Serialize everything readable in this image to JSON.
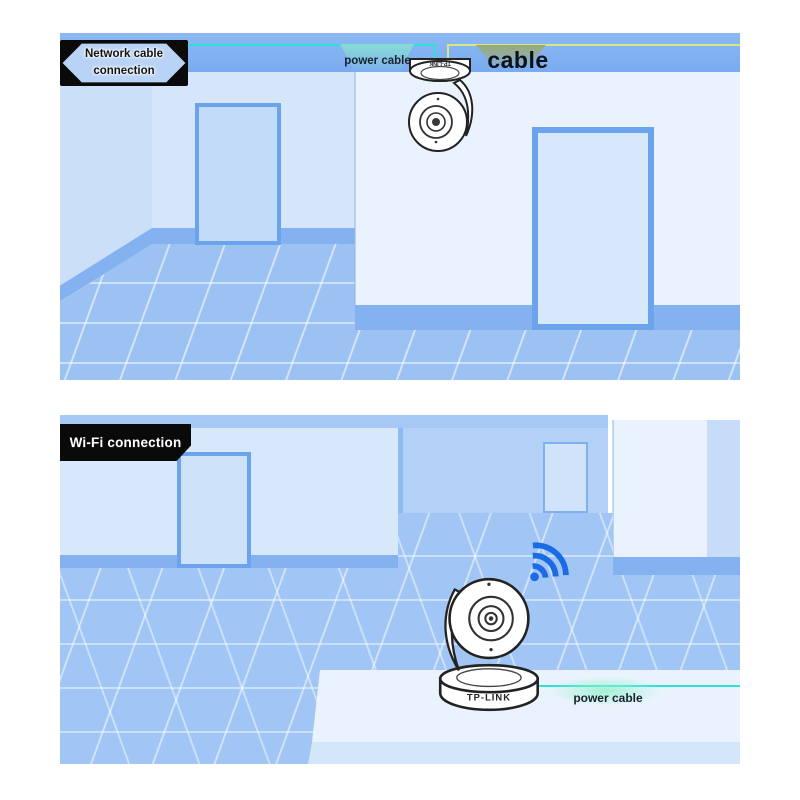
{
  "scene": {
    "top_panel": {
      "label": "Network cable connection",
      "power_cable_label": "power cable",
      "network_cable_label": "cable",
      "camera_brand": "TP-LINK"
    },
    "bottom_panel": {
      "label": "Wi-Fi connection",
      "power_cable_label": "power cable",
      "camera_brand": "TP-LINK"
    },
    "colors": {
      "power_cable": "#2be2d7",
      "power_cable_highlight": "#8fd9d3",
      "network_cable": "#d9e87e",
      "network_cable_highlight": "#9aaa72",
      "wifi_icon": "#1b6be5",
      "label_background": "#0a0a0a",
      "room_blue": "#80b1f1",
      "wall_light": "#e9f2fd",
      "floor_blue": "#9cc2f3"
    }
  }
}
